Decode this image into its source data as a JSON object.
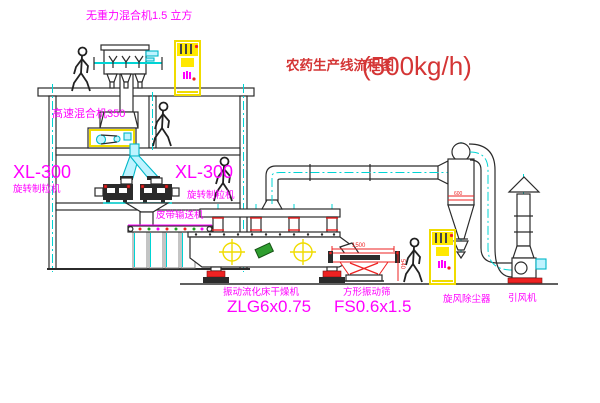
{
  "title": {
    "main": "农药生产线流程图",
    "capacity": "(500kg/h)"
  },
  "labels": {
    "gravity_mixer": "无重力混合机1.5 立方",
    "high_speed_mixer": "高速混合机350",
    "granulator_left": {
      "model": "XL-300",
      "name": "旋转制粒机"
    },
    "granulator_right": {
      "model": "XL-300",
      "name": "旋转制粒机"
    },
    "belt_conveyor": "皮带输送机",
    "dryer": {
      "name": "振动流化床干燥机",
      "model": "ZLG6x0.75"
    },
    "screen": {
      "name": "方形振动筛",
      "model": "FS0.6x1.5"
    },
    "cyclone": "旋风除尘器",
    "fan": "引风机"
  },
  "dimensions": {
    "screen_length": "1500",
    "screen_height": "540",
    "cyclone_note": "600"
  },
  "colors": {
    "magenta": "#ff00ff",
    "title_red": "#d43535",
    "dim_red": "#ee2222",
    "yellow": "#ffe800",
    "cyan": "#00d4d4",
    "line": "#2b2b2b",
    "green": "#2f9e2f"
  }
}
